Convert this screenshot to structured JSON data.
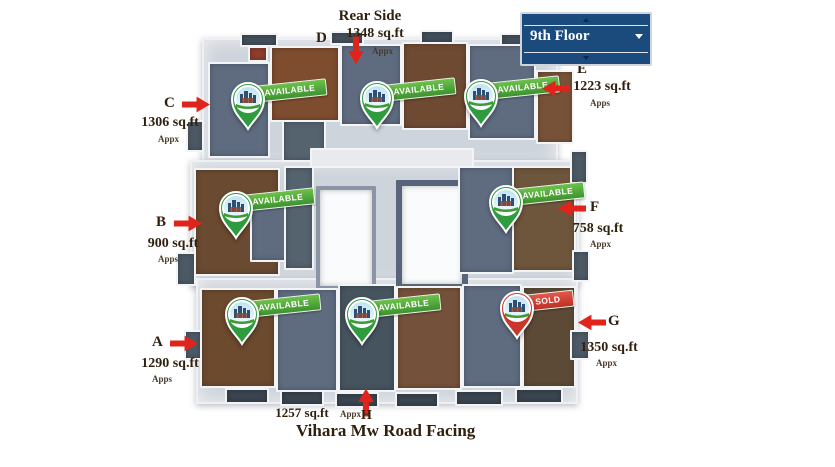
{
  "floor_selector": {
    "value": "9th Floor"
  },
  "labels": {
    "rear_side": "Rear Side",
    "road": "Vihara Mw Road Facing"
  },
  "units": [
    {
      "letter": "A",
      "sqft": "1290 sq.ft",
      "approx": "Apps",
      "status": "AVAILABLE"
    },
    {
      "letter": "B",
      "sqft": "900 sq.ft",
      "approx": "Apps",
      "status": "AVAILABLE"
    },
    {
      "letter": "C",
      "sqft": "1306 sq.ft",
      "approx": "Appx",
      "status": "AVAILABLE"
    },
    {
      "letter": "D",
      "sqft": "1348 sq.ft",
      "approx": "Appx",
      "status": "AVAILABLE"
    },
    {
      "letter": "E",
      "sqft": "1223 sq.ft",
      "approx": "Apps",
      "status": "AVAILABLE"
    },
    {
      "letter": "F",
      "sqft": "758 sq.ft",
      "approx": "Appx",
      "status": "AVAILABLE"
    },
    {
      "letter": "G",
      "sqft": "1350 sq.ft",
      "approx": "Appx",
      "status": "SOLD"
    },
    {
      "letter": "H",
      "sqft": "1257 sq.ft",
      "approx": "Appx",
      "status": "AVAILABLE"
    }
  ],
  "colors": {
    "navy": "#1b4a7c",
    "arrow_red": "#e0241b",
    "available_green": "#3f9a2f",
    "sold_red": "#c9372c",
    "text_brown": "#30210f"
  }
}
